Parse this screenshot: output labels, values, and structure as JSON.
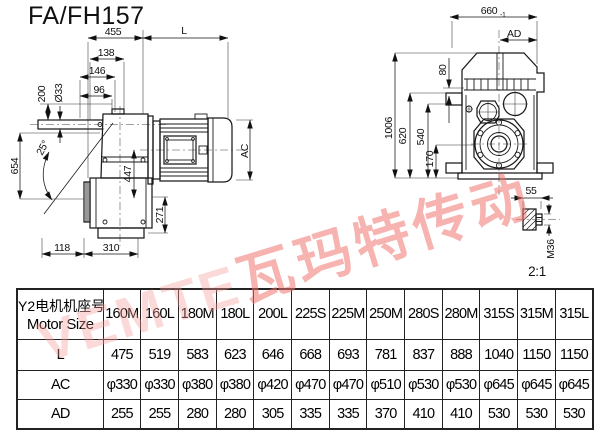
{
  "title": "FA/FH157",
  "watermark": {
    "latin": "VEMTE",
    "cjk": "瓦玛特传动",
    "color": "#ee7470"
  },
  "left_view": {
    "d455": "455",
    "dL": "L",
    "d138": "138",
    "d146": "146",
    "d96": "96",
    "d200": "200",
    "d33": "Ø33",
    "d654": "654",
    "angle": "25°",
    "d447": "447",
    "d271": "271",
    "d118": "118",
    "d310": "310",
    "dAC": "AC"
  },
  "right_view": {
    "d660": "660",
    "d660_tol": "-1",
    "dAD": "AD",
    "d1006": "1006",
    "d620": "620",
    "d540": "540",
    "d80": "80",
    "d170": "170",
    "d55": "55",
    "m36": "M36",
    "scale": "2:1"
  },
  "table": {
    "header_cn": "Y2电机机座号",
    "header_en": "Motor Size",
    "columns": [
      "160M",
      "160L",
      "180M",
      "180L",
      "200L",
      "225S",
      "225M",
      "250M",
      "280S",
      "280M",
      "315S",
      "315M",
      "315L"
    ],
    "rows": [
      {
        "label": "L",
        "values": [
          "475",
          "519",
          "583",
          "623",
          "646",
          "668",
          "693",
          "781",
          "837",
          "888",
          "1040",
          "1150",
          "1150"
        ]
      },
      {
        "label": "AC",
        "values": [
          "φ330",
          "φ330",
          "φ380",
          "φ380",
          "φ420",
          "φ470",
          "φ470",
          "φ510",
          "φ530",
          "φ530",
          "φ645",
          "φ645",
          "φ645"
        ]
      },
      {
        "label": "AD",
        "values": [
          "255",
          "255",
          "280",
          "280",
          "305",
          "335",
          "335",
          "370",
          "410",
          "410",
          "530",
          "530",
          "530"
        ]
      }
    ]
  }
}
